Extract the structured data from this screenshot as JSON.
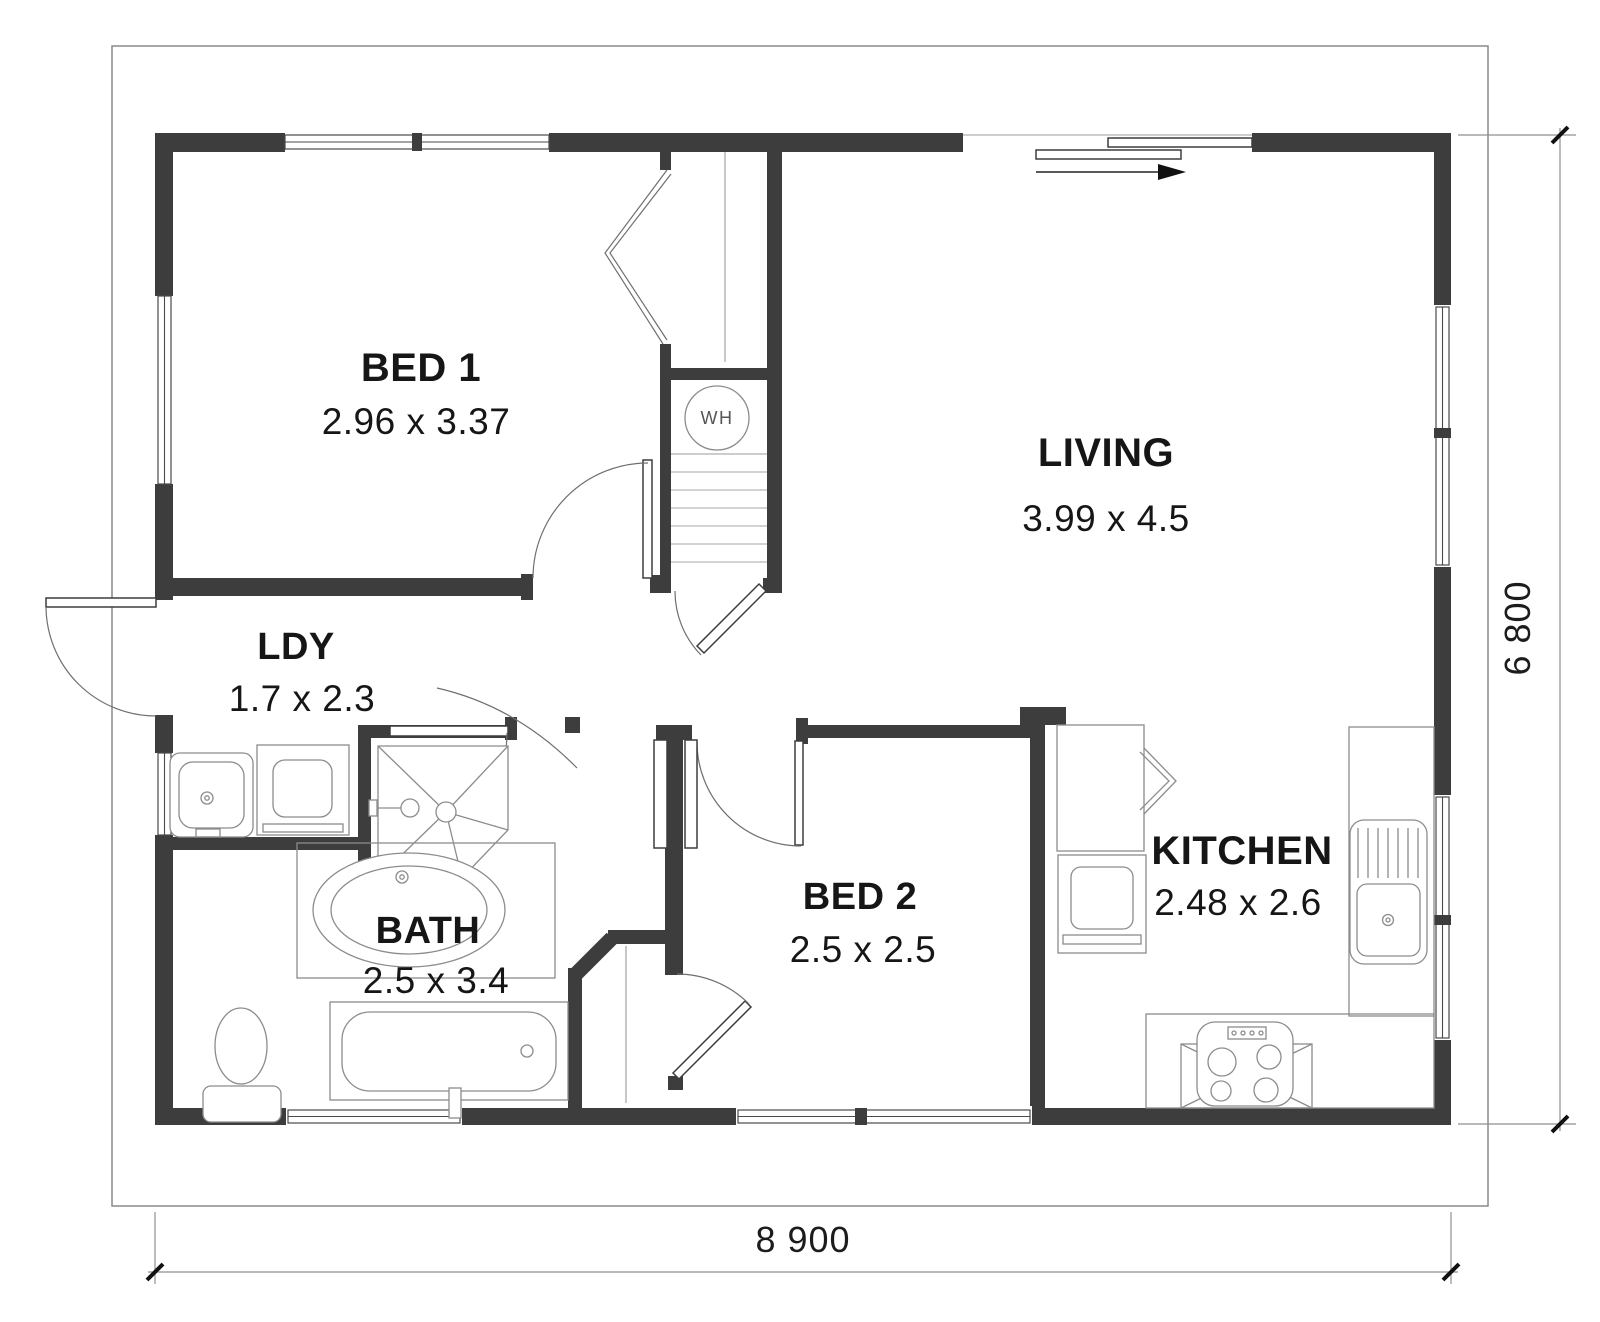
{
  "plan": {
    "rooms": {
      "bed1": {
        "name": "BED 1",
        "dims": "2.96 x 3.37"
      },
      "living": {
        "name": "LIVING",
        "dims": "3.99 x 4.5"
      },
      "ldy": {
        "name": "LDY",
        "dims": "1.7 x 2.3"
      },
      "bath": {
        "name": "BATH",
        "dims": "2.5 x 3.4"
      },
      "bed2": {
        "name": "BED 2",
        "dims": "2.5 x 2.5"
      },
      "kitchen": {
        "name": "KITCHEN",
        "dims": "2.48 x 2.6"
      }
    },
    "labels": {
      "water_heater": "WH"
    },
    "dimensions": {
      "overall_width": "8 900",
      "overall_height": "6 800"
    },
    "colors": {
      "wall": "#3d3d3d",
      "fixture_line": "#8c8c8c",
      "text": "#161616"
    }
  }
}
